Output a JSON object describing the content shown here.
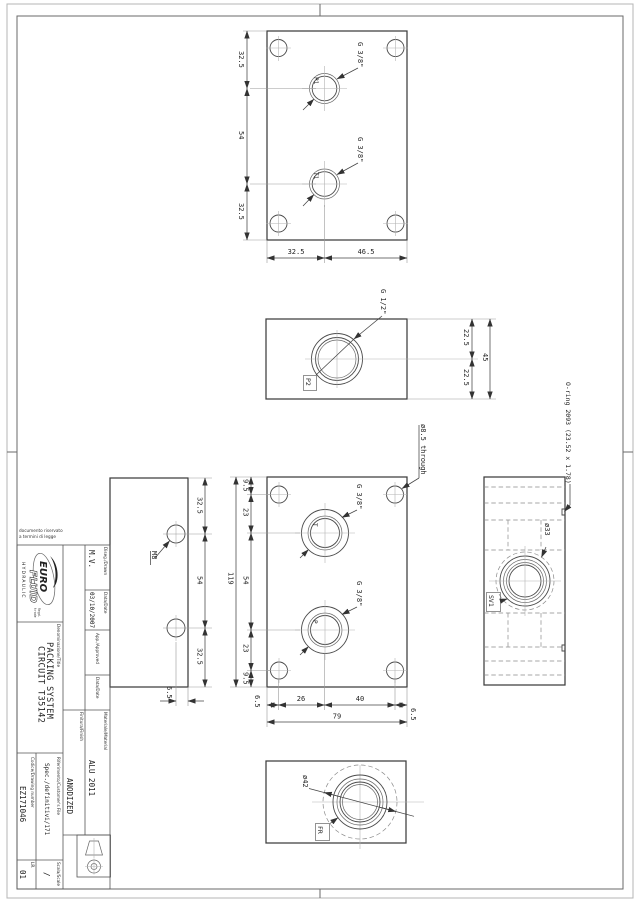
{
  "sheet_note": {
    "line1": "documento riservato",
    "line2": "a termini di legge"
  },
  "logo": {
    "word1": "EURO",
    "word2": "FLUID",
    "subtitle": "HYDRAULIC",
    "regd1": "Regd.",
    "regd2": "trade"
  },
  "title_block": {
    "drawn_label": "Diseg./Drawn",
    "drawn_value": "M.V.",
    "date1_label": "Data/Date",
    "date1_value": "03/10/2007",
    "approved_label": "App./Approved",
    "date2_label": "Data/Date",
    "material_label": "Materiale/Material",
    "material_value": "ALU 2011",
    "finish_label": "Finitura/Finish",
    "finish_value": "ANODIZED",
    "title_label": "Denominazione/Title",
    "title_line1": "PACKING SYSTEM",
    "title_line2": "CIRCUIT T35142",
    "reference_label": "Riferimento/Customer's File",
    "reference_value": "Spec./definitivi/171",
    "code_label": "Codice/Drawing number",
    "code_value": "EZ171046",
    "scale_label": "Scala/Scale",
    "scale_value": "/",
    "rev_label": "LR.",
    "rev_value": "01"
  },
  "views": {
    "top_face": {
      "port_labels": [
        "P1",
        "T1"
      ],
      "thread_callouts": [
        "G 3/8\"",
        "G 3/8\""
      ],
      "dims_left": [
        "32.5",
        "54",
        "32.5"
      ],
      "dims_bottom": [
        "32.5",
        "46.5"
      ]
    },
    "side_p2": {
      "port_label": "P2",
      "thread_callout": "G 1/2\"",
      "dims_right": [
        "22.5",
        "22.5"
      ],
      "dim_total": "45"
    },
    "back_face": {
      "hole_callout": "ø8.5 through",
      "port_labels": [
        "T",
        "P"
      ],
      "thread_callouts": [
        "G 3/8\"",
        "G 3/8\""
      ],
      "dims_left": [
        "9.5",
        "23",
        "54",
        "23",
        "9.5"
      ],
      "dim_height_total": "119",
      "dims_bottom": [
        "6.5",
        "26",
        "40",
        "6.5"
      ],
      "dim_width_total": "79"
    },
    "side_m8": {
      "thread_callout": "M8",
      "dims_right": [
        "32.5",
        "54",
        "32.5"
      ],
      "dim_bottom": "6.5"
    },
    "side_sv": {
      "oring_callout": "O-ring 2093 (23.52 x 1.78)",
      "diameter_callout": "ø33",
      "port_label": "SV1"
    },
    "bottom_face": {
      "diameter_callout": "ø42",
      "port_label": "FR"
    }
  }
}
